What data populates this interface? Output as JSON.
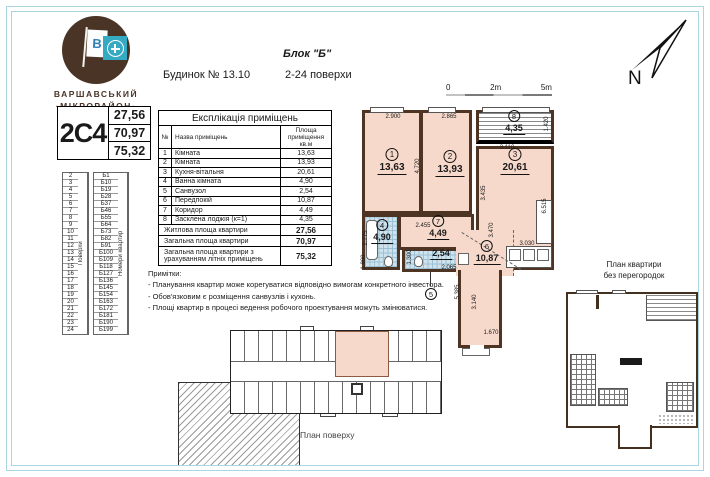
{
  "brand": {
    "flag_letter": "В",
    "line1": "ВАРШАВСЬКИЙ",
    "line2": "·МІКРОРАЙОН·"
  },
  "header": {
    "block": "Блок \"Б\"",
    "building": "Будинок № 13.10",
    "floors_range": "2-24 поверхи"
  },
  "compass": {
    "label": "N"
  },
  "apartment_badge": {
    "code": "2С4",
    "values": [
      "27,56",
      "70,97",
      "75,32"
    ]
  },
  "floors_table": {
    "floors_header": "Поверхи",
    "apartments_header": "Номери квартир",
    "rows": [
      {
        "floor": "2",
        "apt": "Б1"
      },
      {
        "floor": "3",
        "apt": "Б10"
      },
      {
        "floor": "4",
        "apt": "Б19"
      },
      {
        "floor": "5",
        "apt": "Б28"
      },
      {
        "floor": "6",
        "apt": "Б37"
      },
      {
        "floor": "7",
        "apt": "Б46"
      },
      {
        "floor": "8",
        "apt": "Б55"
      },
      {
        "floor": "9",
        "apt": "Б64"
      },
      {
        "floor": "10",
        "apt": "Б73"
      },
      {
        "floor": "11",
        "apt": "Б82"
      },
      {
        "floor": "12",
        "apt": "Б91"
      },
      {
        "floor": "13",
        "apt": "Б100"
      },
      {
        "floor": "14",
        "apt": "Б109"
      },
      {
        "floor": "15",
        "apt": "Б118"
      },
      {
        "floor": "16",
        "apt": "Б127"
      },
      {
        "floor": "17",
        "apt": "Б136"
      },
      {
        "floor": "18",
        "apt": "Б145"
      },
      {
        "floor": "19",
        "apt": "Б154"
      },
      {
        "floor": "20",
        "apt": "Б163"
      },
      {
        "floor": "21",
        "apt": "Б172"
      },
      {
        "floor": "22",
        "apt": "Б181"
      },
      {
        "floor": "23",
        "apt": "Б190"
      },
      {
        "floor": "24",
        "apt": "Б199"
      }
    ]
  },
  "explication": {
    "title": "Експлікація приміщень",
    "columns": {
      "num": "№",
      "name": "Назва приміщень",
      "area": "Площа приміщення кв.м"
    },
    "rows": [
      {
        "num": "1",
        "name": "Кімната",
        "area": "13,63"
      },
      {
        "num": "2",
        "name": "Кімната",
        "area": "13,93"
      },
      {
        "num": "3",
        "name": "Кухня-вітальня",
        "area": "20,61"
      },
      {
        "num": "4",
        "name": "Ванна кімната",
        "area": "4,90"
      },
      {
        "num": "5",
        "name": "Санвузол",
        "area": "2,54"
      },
      {
        "num": "6",
        "name": "Передпокій",
        "area": "10,87"
      },
      {
        "num": "7",
        "name": "Коридор",
        "area": "4,49"
      },
      {
        "num": "8",
        "name": "Засклена лоджія (к=1)",
        "area": "4,35"
      }
    ],
    "totals": [
      {
        "label": "Житлова площа квартири",
        "value": "27,56"
      },
      {
        "label": "Загальна площа квартири",
        "value": "70,97"
      },
      {
        "label": "Загальна площа квартири з урахуванням літніх приміщень",
        "value": "75,32"
      }
    ]
  },
  "notes": {
    "title": "Примітки:",
    "items": [
      "- Планування квартир може корегуватися відповідно вимогам конкретного інвестора.",
      "- Обов'язковим є розміщення санвузлів і кухонь.",
      "- Площі квартир в процесі ведення  робочого проектування  можуть змінюватися."
    ]
  },
  "scale_bar": {
    "ticks": [
      "0",
      "2m",
      "5m"
    ]
  },
  "plan": {
    "rooms": [
      {
        "num": "1",
        "area": "13,63"
      },
      {
        "num": "2",
        "area": "13,93"
      },
      {
        "num": "3",
        "area": "20,61"
      },
      {
        "num": "4",
        "area": "4,90"
      },
      {
        "num": "5",
        "area": "2,54"
      },
      {
        "num": "6",
        "area": "10,87"
      },
      {
        "num": "7",
        "area": "4,49"
      },
      {
        "num": "8",
        "area": "4,35"
      }
    ],
    "dimensions": [
      "2.900",
      "2.865",
      "4.720",
      "1.420",
      "3.110",
      "3.435",
      "6.515",
      "2.775",
      "1.800",
      "2.455",
      "1.300",
      "2.065",
      "3.470",
      "5.385",
      "3.030",
      "3.140",
      "1.670"
    ]
  },
  "mini_plan": {
    "label_line1": "План квартири",
    "label_line2": "без перегородок"
  },
  "floor_overview": {
    "label": "План поверху"
  },
  "colors": {
    "frame": "#a9d6e0",
    "wall": "#4e3423",
    "room_fill": "#f6d9cb",
    "tile_blue": "#cfe3ee",
    "logo_brown": "#4a3426",
    "logo_teal": "#35aac2"
  }
}
